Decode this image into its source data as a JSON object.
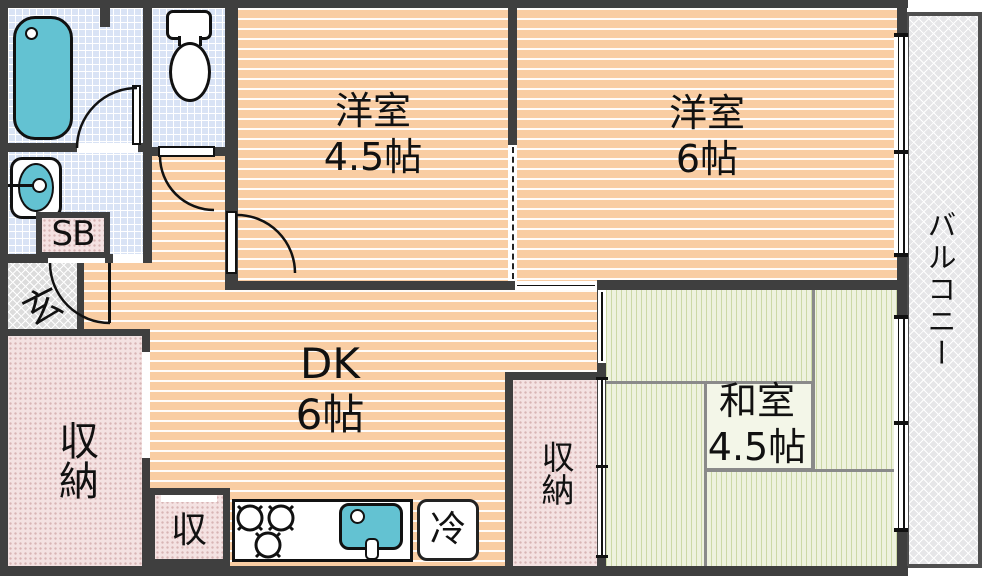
{
  "floor_plan": {
    "title": "2DK apartment floor plan",
    "rooms": {
      "western_room_small": {
        "label": "洋室",
        "size": "4.5帖"
      },
      "western_room_large": {
        "label": "洋室",
        "size": "6帖"
      },
      "dining_kitchen": {
        "label": "DK",
        "size": "6帖"
      },
      "japanese_room": {
        "label": "和室",
        "size": "4.5帖"
      },
      "balcony": {
        "label": "バルコニー"
      },
      "entrance": {
        "label": "玄"
      },
      "shoe_box": {
        "label": "SB"
      },
      "storage_hall": {
        "label": "収納"
      },
      "storage_closet": {
        "label": "収納"
      },
      "storage_small": {
        "label": "収"
      },
      "refrigerator": {
        "label": "冷"
      }
    },
    "fixtures": [
      "bathtub",
      "toilet",
      "washbasin",
      "stove-burners",
      "kitchen-sink",
      "refrigerator"
    ],
    "colors": {
      "wall": "#3f3f3f",
      "wood_floor": "#f9cda3",
      "tile_floor": "#d9e3f5",
      "tatami": "#eef2de",
      "storage_fill": "#f4e2e2",
      "fixture_blue": "#63c2d2",
      "balcony_fill": "#e6e6e8"
    }
  }
}
